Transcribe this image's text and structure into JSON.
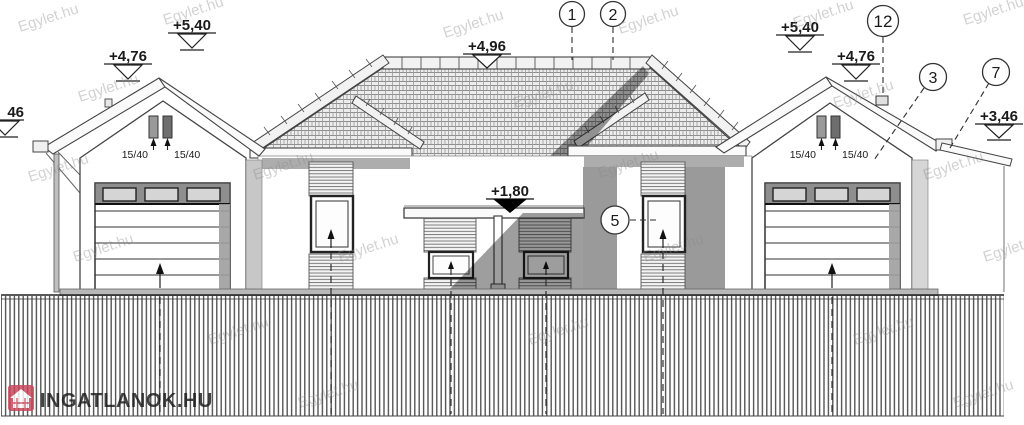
{
  "watermark": {
    "text": "Egylet.hu"
  },
  "logo": {
    "text": "INGATLANOK.HU",
    "color": "#c84458"
  },
  "markers": {
    "left_346_partial": "46",
    "left_476": "+4,76",
    "left_540": "+5,40",
    "ridge_496": "+4,96",
    "right_540": "+5,40",
    "right_476": "+4,76",
    "right_346": "+3,46",
    "porch_180": "+1,80"
  },
  "axes": {
    "a1": "1",
    "a2": "2",
    "a12": "12",
    "a3": "3",
    "a7": "7",
    "a5": "5"
  },
  "vents": {
    "left_a": "15/40",
    "left_b": "15/40",
    "right_a": "15/40",
    "right_b": "15/40"
  },
  "colors": {
    "line": "#333333",
    "roof_tile": "#8f8f8f",
    "shadow": "rgba(0,0,0,0.40)",
    "logo_red": "#c84458",
    "watermark_gray": "#8a8a8a"
  }
}
